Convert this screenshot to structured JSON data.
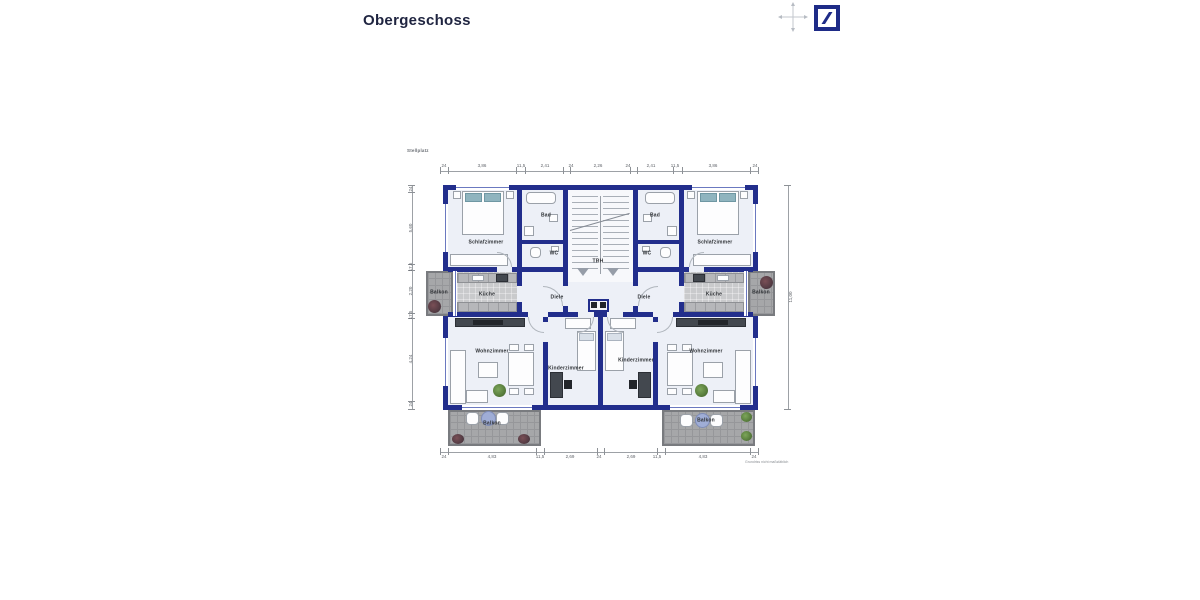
{
  "header": {
    "title": "Obergeschoss"
  },
  "branding": {
    "logo": "Deutsche Bank",
    "logo_color": "#1e2b87"
  },
  "icons": {
    "north_arrow": "north-arrow-icon",
    "logo": "deutsche-bank-logo-icon"
  },
  "plan": {
    "site_label": "Stellplatz",
    "small_print": "Grundriss nicht maßstäblich",
    "wall_color": "#222e8c",
    "labels": {
      "trh": "TRH",
      "schlafzimmer_l": "Schlafzimmer",
      "schlafzimmer_r": "Schlafzimmer",
      "bad_l": "Bad",
      "bad_r": "Bad",
      "wc_l": "WC",
      "wc_r": "WC",
      "kueche_l": "Küche",
      "kueche_r": "Küche",
      "diele_l": "Diele",
      "diele_r": "Diele",
      "wohnzimmer_l": "Wohnzimmer",
      "wohnzimmer_r": "Wohnzimmer",
      "kinderzimmer_l": "Kinderzimmer",
      "kinderzimmer_r": "Kinderzimmer",
      "balkon_side_l": "Balkon",
      "balkon_side_r": "Balkon",
      "balkon_bottom_l": "Balkon",
      "balkon_bottom_r": "Balkon"
    },
    "dims": {
      "top": [
        "24",
        "3,86",
        "11,5",
        "2,41",
        "24",
        "2,26",
        "24",
        "2,41",
        "11,5",
        "3,86",
        "24"
      ],
      "bottom": [
        "24",
        "4,83",
        "11,5",
        "2,69",
        "24",
        "2,69",
        "11,5",
        "4,83",
        "24"
      ],
      "left": [
        "24",
        "5,60",
        "17,5",
        "2,20",
        "17,5",
        "4,24",
        "24"
      ],
      "right": [
        "11,00"
      ]
    }
  }
}
